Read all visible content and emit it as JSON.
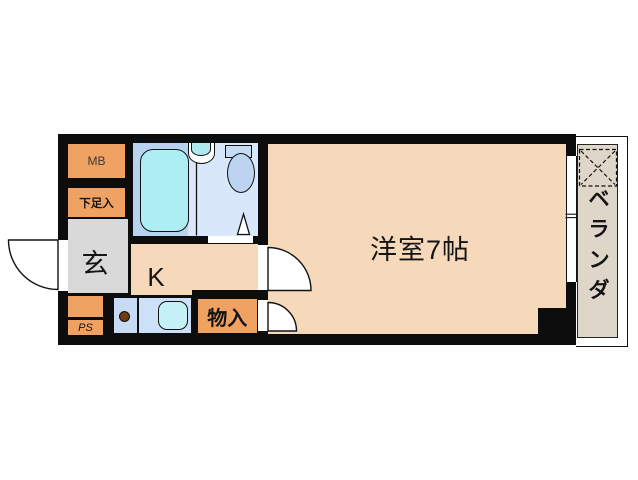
{
  "floorplan": {
    "labels": {
      "main_room": "洋室7帖",
      "kitchen": "K",
      "entrance": "玄",
      "storage": "物入",
      "meter_box": "MB",
      "shoe_cabinet": "下足入",
      "pipe_space": "PS",
      "balcony": "ベランダ",
      "balcony_chars": [
        "ベ",
        "ラ",
        "ン",
        "ダ"
      ]
    },
    "colors": {
      "wall": "#0d0d0d",
      "room-fill": "#f6d8ba",
      "cabinet-orange": "#f0a262",
      "entrance-gray": "#d9d9d9",
      "bath-floor": "#d8e8fa",
      "bath-left-floor": "#b6d4f0",
      "bathtub": "#aceef2",
      "sink-cyan": "#aee9ee",
      "toilet-tank": "#c6dcf4",
      "toilet-bowl": "#bcd4ef",
      "counter-cell": "#c7dbf5",
      "counter-cell2": "#cce0f8",
      "kitchen-sink": "#c4f2f6",
      "burner-brown": "#6e3c12",
      "balcony-floor": "#ded6c9"
    }
  }
}
